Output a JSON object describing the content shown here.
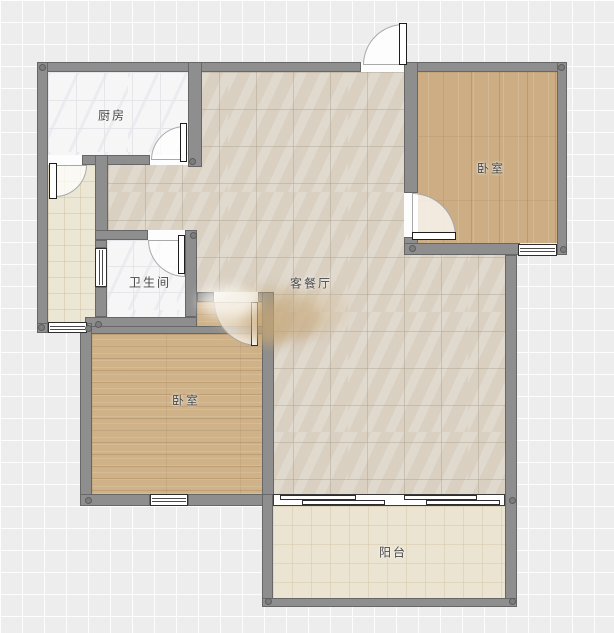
{
  "plan": {
    "title": "apartment-floor-plan",
    "rooms": {
      "kitchen": {
        "label": "厨房"
      },
      "bedroom_top": {
        "label": "卧室"
      },
      "bathroom": {
        "label": "卫生间"
      },
      "living_dining": {
        "label": "客餐厅"
      },
      "bedroom_bottom": {
        "label": "卧室"
      },
      "balcony": {
        "label": "阳台"
      }
    },
    "colors": {
      "background": "#ededee",
      "wall": "#8e8e8e",
      "living_floor": "#ddd5c8",
      "wood_top": "#cdae84",
      "wood_bottom": "#d0b289",
      "white_tile": "#f6f6f7",
      "hallway_floor": "#ece6d4",
      "balcony_floor": "#ebe4d2",
      "label_text": "#474747"
    }
  }
}
